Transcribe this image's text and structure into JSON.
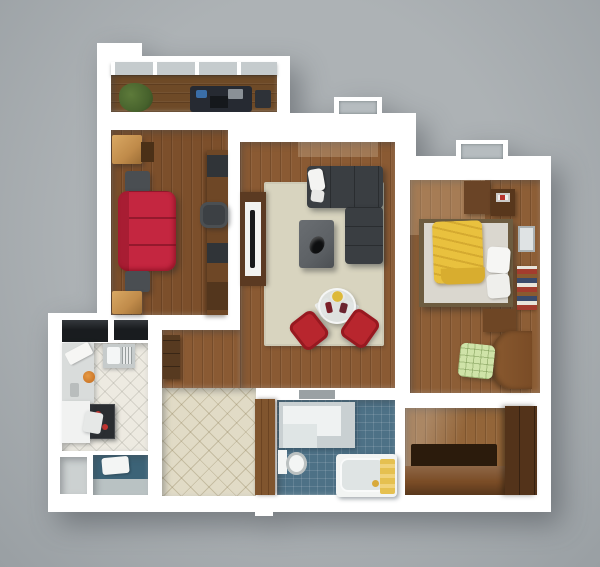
{
  "canvas": {
    "width": 600,
    "height": 567,
    "description": "3D top-down render of a one-bedroom apartment floor plan on a plain gray background"
  },
  "palette": {
    "background": "#adb2b5",
    "wall": "#ffffff",
    "glass": "#b6bcbf",
    "railing": "#c5cbcd",
    "wood_balcony": "#6e4a27",
    "wood_office": "#7c4f2b",
    "wood_living": "#8a5a33",
    "wood_bedroom": "#8d5e36",
    "wood_entry": "#936539",
    "rug": "#d8d4bf",
    "sofa_gray": "#3a3e42",
    "table_gray": "#5d6165",
    "sofa_red": "#c42640",
    "chair_red": "#b8262e",
    "oak": "#c08b4a",
    "equipment": "#303438",
    "blanket_yellow": "#e9c13e",
    "mattress": "#dad7cf",
    "bedframe": "#6d5c40",
    "chair_green": "#cfe3a8",
    "tile_kitchen": "#edeae1",
    "tile_hall": "#e1dbc6",
    "bath_floor": "#4d7186",
    "wc_floor": "#3c6377",
    "fixture": "#f3f5f4",
    "door_brown": "#80552e",
    "wardrobe": "#53331a",
    "cabinet_brown": "#7a4c26",
    "mat_dark": "#2b1b0c",
    "counter": "#d9dcdb",
    "stove": "#2a2d31",
    "plant": "#46612c",
    "dark_tops": "#191c1f"
  },
  "rooms": {
    "balcony": {
      "label": "Balcony",
      "items": [
        "glass railing",
        "potted plant",
        "stored bikes and boxes"
      ]
    },
    "office": {
      "label": "Study room",
      "items": [
        "red sofa",
        "two dark side tables",
        "two oak cabinets",
        "computer desk",
        "office chair",
        "monitor",
        "printer"
      ]
    },
    "living_room": {
      "label": "Living room",
      "items": [
        "dark gray corner sofa",
        "white pillows",
        "beige area rug",
        "gray coffee table with bowl",
        "TV unit with flat TV",
        "round glass dining table",
        "two red chairs",
        "plate of food"
      ]
    },
    "bedroom": {
      "label": "Bedroom",
      "items": [
        "double bed",
        "yellow blanket",
        "white pillows",
        "dresser",
        "nightstand with picture",
        "wall mirror",
        "book shelf",
        "curved desk",
        "green checked chair"
      ]
    },
    "kitchen": {
      "label": "Kitchen",
      "items": [
        "counter with cutting board",
        "orange pot",
        "sink with drainboard",
        "stove with red burners",
        "white table",
        "chair",
        "tall cabinet tops"
      ]
    },
    "hallway": {
      "label": "Hallway",
      "items": [
        "beige diamond tile floor",
        "wall cabinet"
      ]
    },
    "bathroom": {
      "label": "Bathroom",
      "items": [
        "shower enclosure",
        "toilet",
        "bathtub",
        "yellow towels",
        "brown door",
        "wall niche"
      ]
    },
    "entry": {
      "label": "Entry hall",
      "items": [
        "dark wardrobe",
        "dark floor mat",
        "low brown cabinet"
      ]
    },
    "storage": {
      "label": "Storage closet",
      "items": []
    },
    "wc": {
      "label": "WC laundry room",
      "items": [
        "white fixture",
        "teal tile floor"
      ]
    }
  }
}
